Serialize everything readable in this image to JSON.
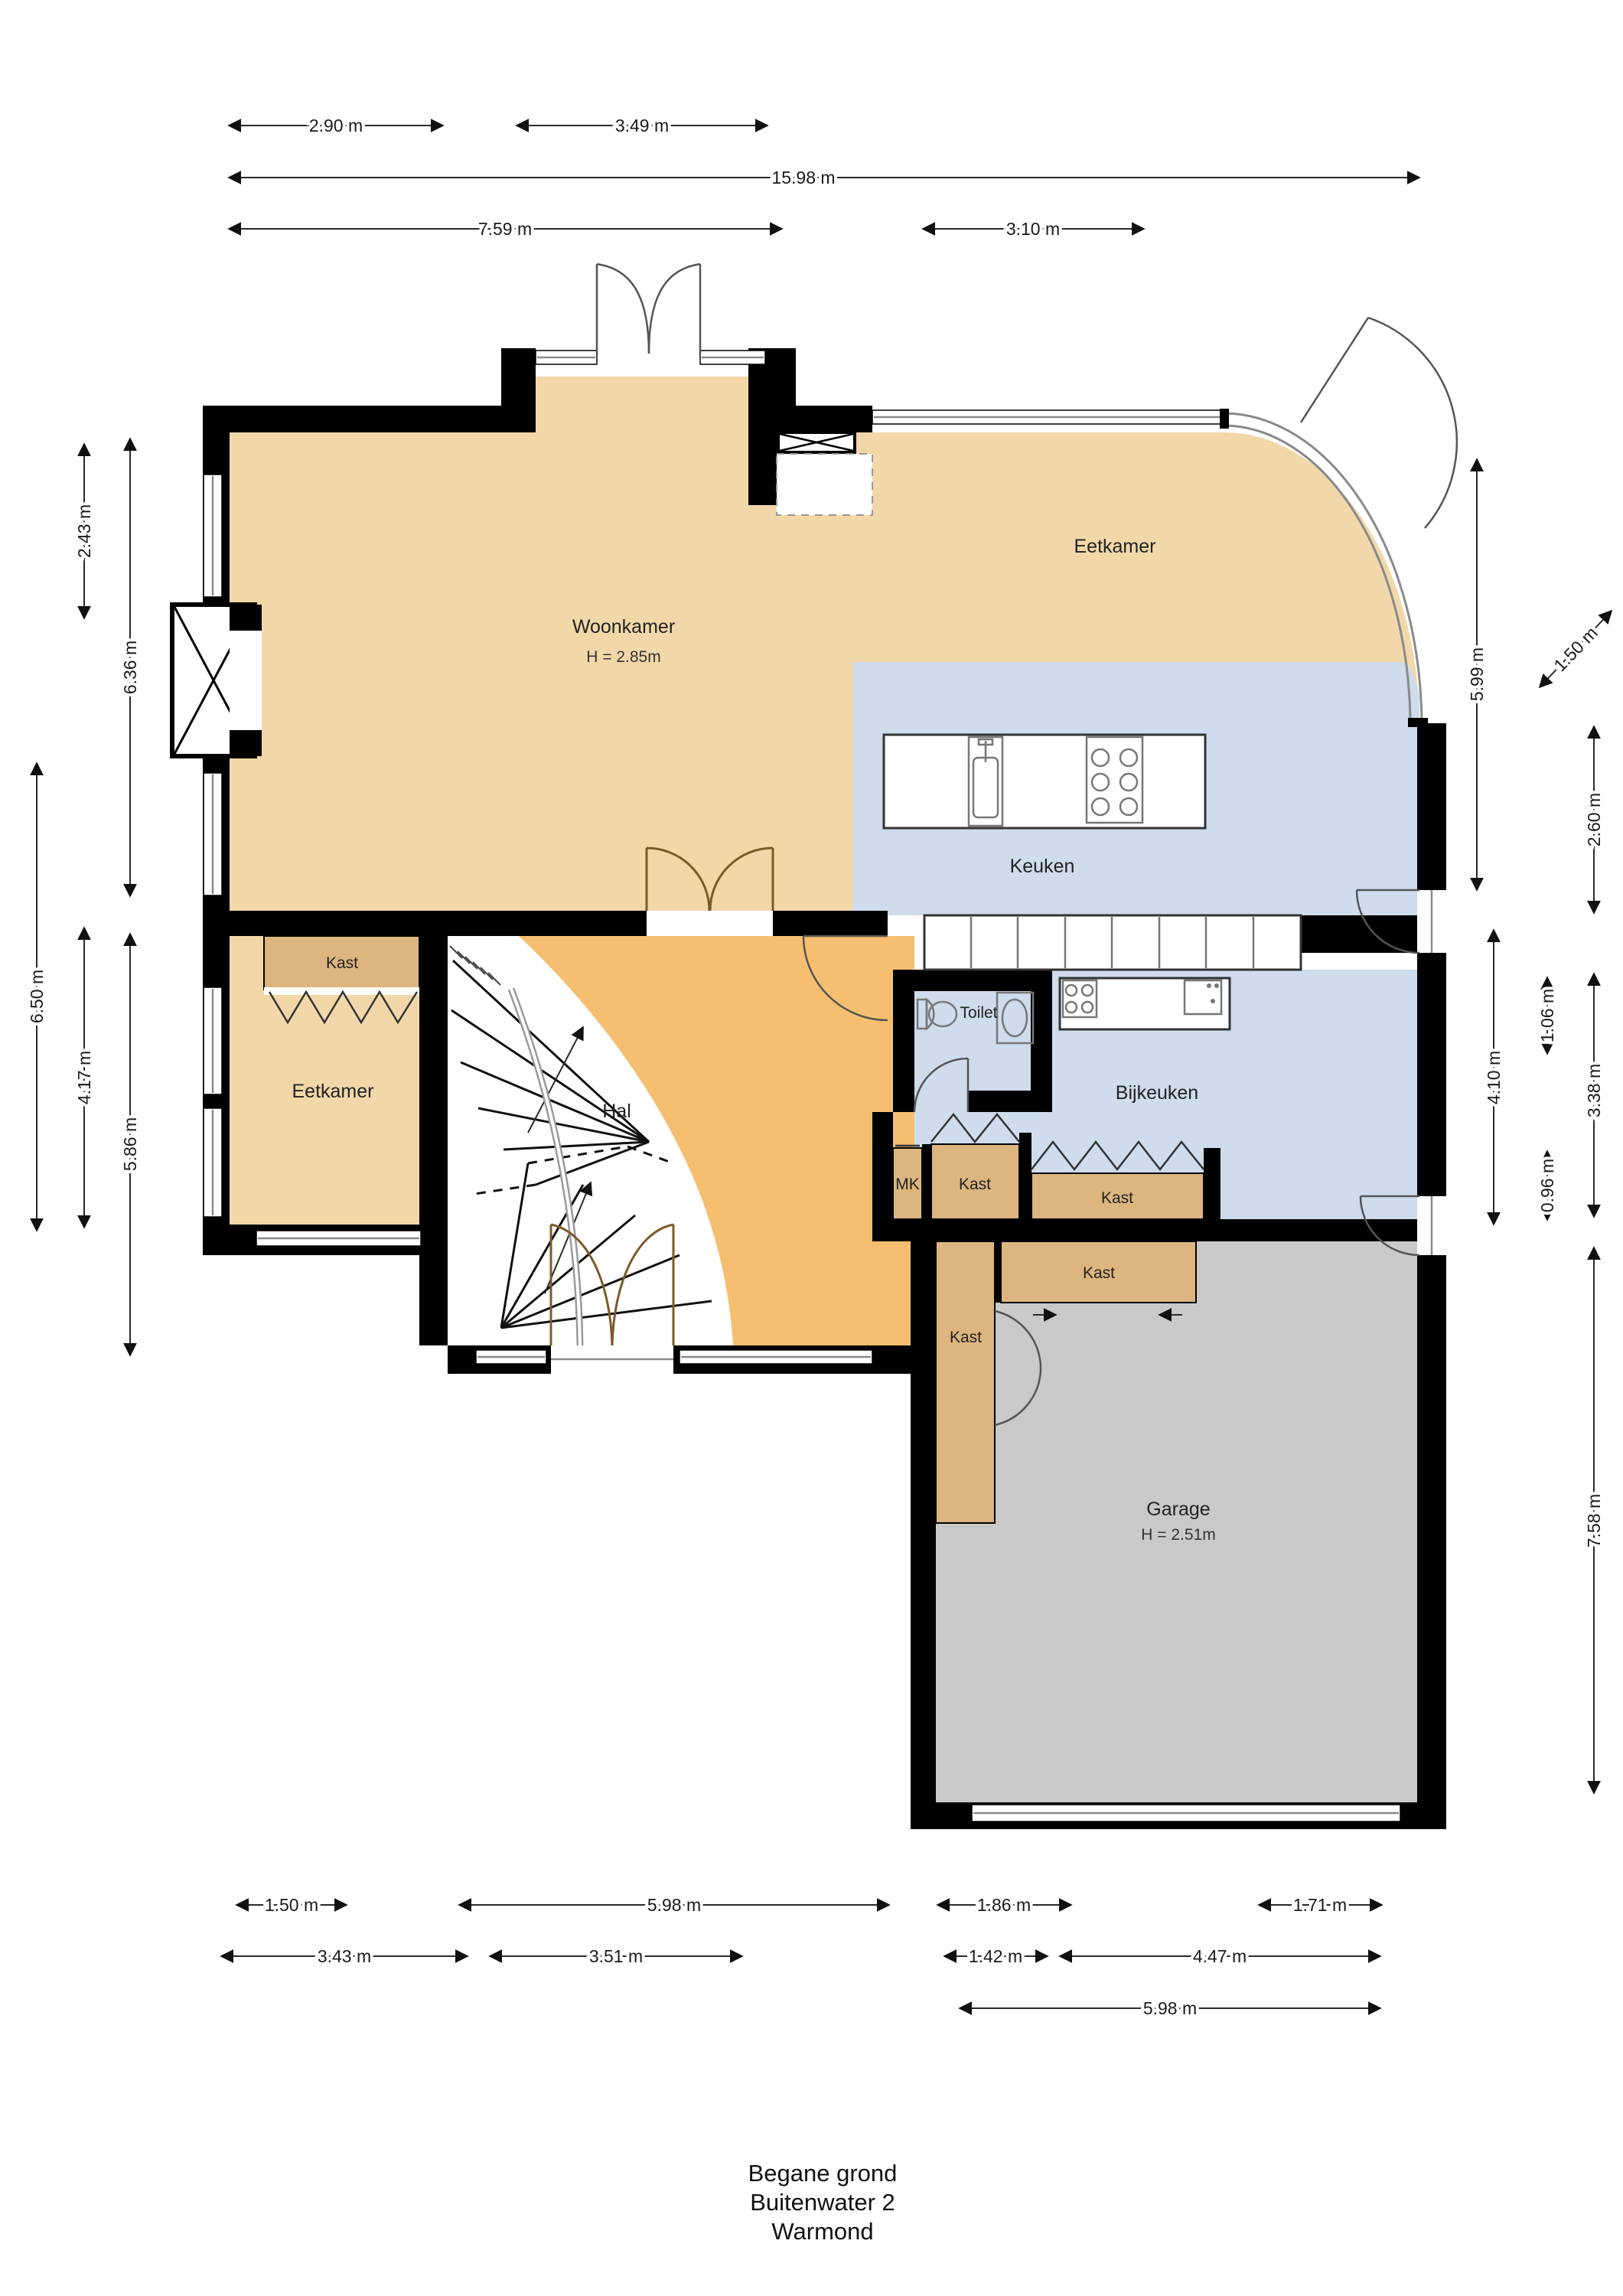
{
  "title": {
    "line1": "Begane grond",
    "line2": "Buitenwater 2",
    "line3": "Warmond"
  },
  "rooms": {
    "woonkamer": {
      "label": "Woonkamer",
      "height": "H = 2.85m"
    },
    "eetkamer_top": {
      "label": "Eetkamer"
    },
    "keuken": {
      "label": "Keuken"
    },
    "toilet": {
      "label": "Toilet"
    },
    "bijkeuken": {
      "label": "Bijkeuken"
    },
    "hal": {
      "label": "Hal"
    },
    "eetkamer_left": {
      "label": "Eetkamer"
    },
    "kast_eetkamer": {
      "label": "Kast"
    },
    "mk": {
      "label": "MK"
    },
    "kast_hal": {
      "label": "Kast"
    },
    "kast_bijkeuken": {
      "label": "Kast"
    },
    "kast_garage": {
      "label": "Kast"
    },
    "kast_garage_side": {
      "label": "Kast"
    },
    "garage": {
      "label": "Garage",
      "height": "H = 2.51m"
    }
  },
  "dimensions": {
    "top": [
      "2.90 m",
      "3.49 m",
      "15.98 m",
      "7.59 m",
      "3.10 m"
    ],
    "left": [
      "2.43 m",
      "6.36 m",
      "6.50 m",
      "4.17 m",
      "5.86 m"
    ],
    "right": [
      "1.50 m",
      "5.99 m",
      "2.60 m",
      "1.06 m",
      "4.10 m",
      "3.38 m",
      "0.96 m",
      "7.58 m"
    ],
    "bottom": [
      "1.50 m",
      "5.98 m",
      "1.86 m",
      "1.71 m",
      "3.43 m",
      "3.51 m",
      "1.42 m",
      "4.47 m",
      "5.98 m"
    ]
  },
  "colors": {
    "living_area": "#F2D8A9",
    "hall": "#F6BE71",
    "kitchen_wet_rooms": "#CEDCEC",
    "closet": "#DCB57F",
    "garage": "#C9C9C9",
    "wall": "#000000"
  }
}
